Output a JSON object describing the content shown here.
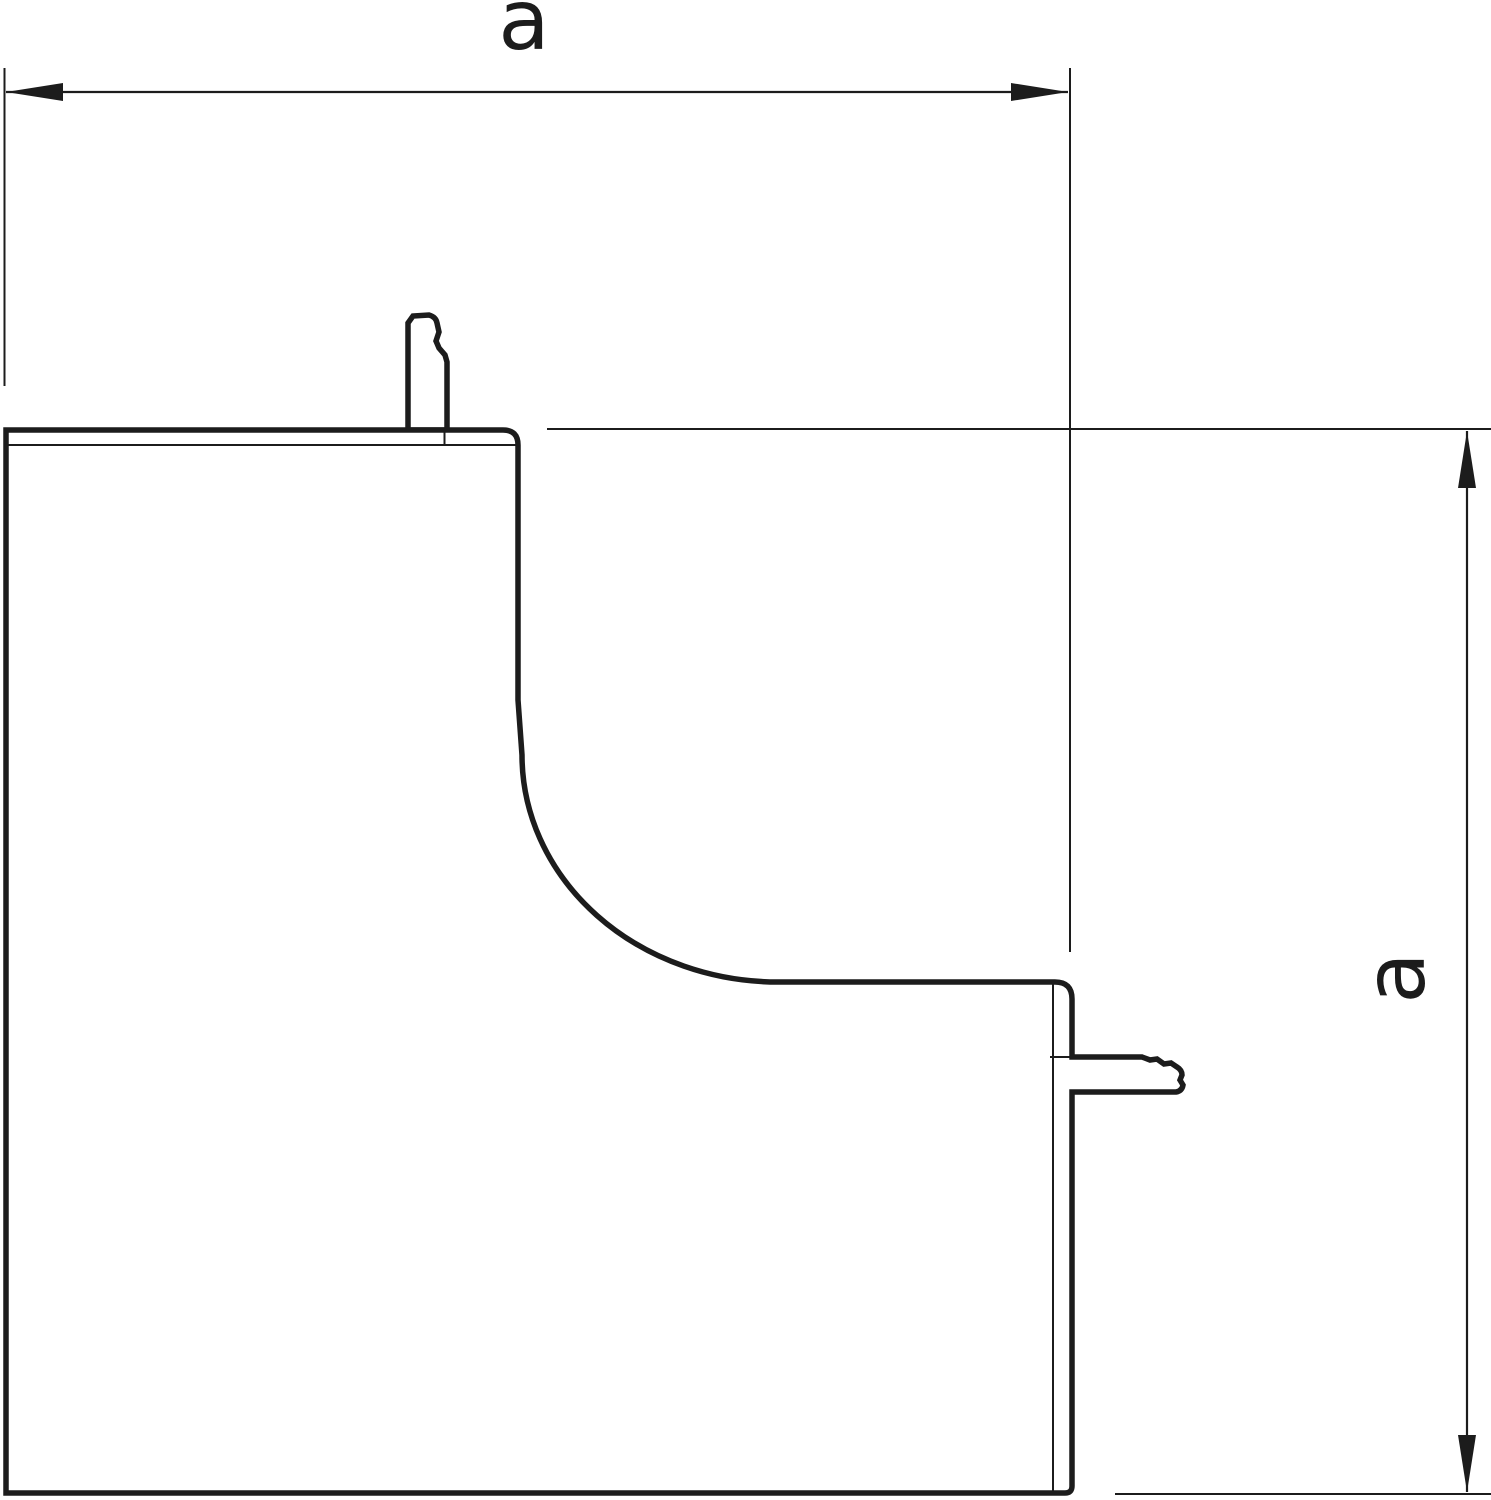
{
  "page": {
    "background_color": "#ffffff",
    "line_color": "#1c1c1c"
  },
  "drawing": {
    "kind": "dimensioned-outline-technical-drawing",
    "figure": "inner-corner-cover-profile-with-retention-clips",
    "labels": {
      "width_dimension": "a",
      "height_dimension": "a"
    }
  }
}
